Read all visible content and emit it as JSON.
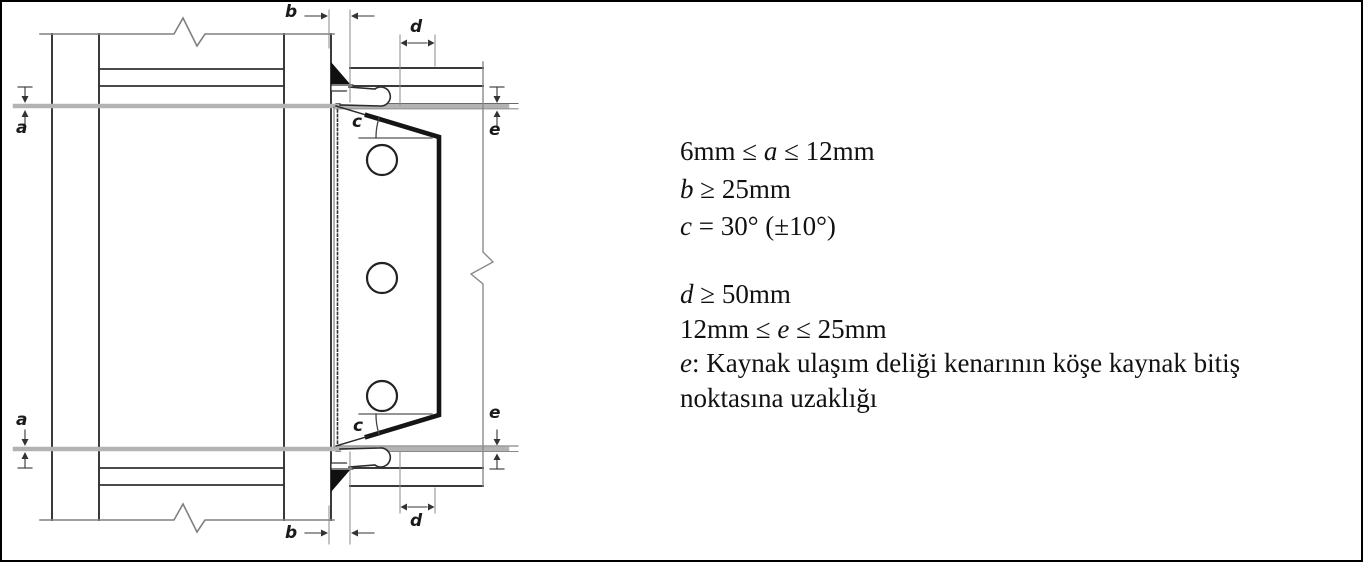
{
  "diagram": {
    "dimension_labels": {
      "a": "a",
      "b": "b",
      "c": "c",
      "d": "d",
      "e": "e"
    }
  },
  "notes": {
    "constraints": [
      {
        "pre": "6mm ≤ ",
        "var": "a",
        "post": " ≤ 12mm"
      },
      {
        "pre": "",
        "var": "b",
        "post": " ≥ 25mm"
      },
      {
        "pre": "",
        "var": "c",
        "post": " = 30° (±10°)"
      },
      {
        "pre": "",
        "var": "d",
        "post": " ≥ 50mm"
      },
      {
        "pre": "12mm ≤ ",
        "var": "e",
        "post": " ≤ 25mm"
      }
    ],
    "definition": {
      "var": "e",
      "sep": ": ",
      "text_line1": "Kaynak ulaşım deliği kenarının köşe kaynak bitiş",
      "text_line2": "noktasına uzaklığı"
    }
  },
  "colors": {
    "line": "#3a3a3a",
    "gray_reference": "#8a8a8a",
    "band": "#b3b3b3",
    "weld_fill": "#101010",
    "background": "#ffffff",
    "border": "#000000"
  }
}
